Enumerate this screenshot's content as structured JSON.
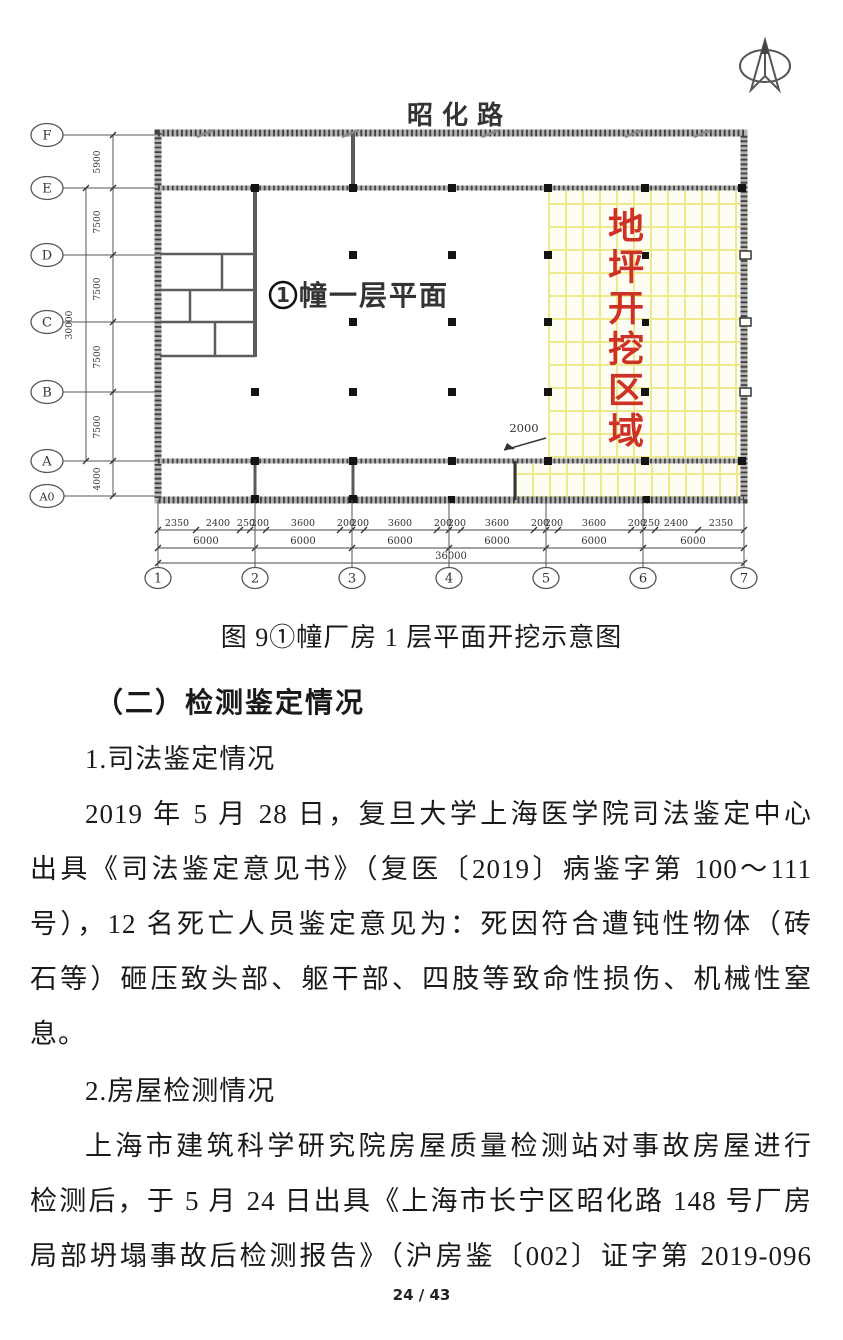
{
  "plan": {
    "road_label": "昭 化 路",
    "unit_circle_digit": "1",
    "unit_label": "幢一层平面",
    "excavation_label": "地坪开挖区域",
    "dim_2000": "2000",
    "row_axes": [
      "F",
      "E",
      "D",
      "C",
      "B",
      "A",
      "A0"
    ],
    "row_dims": [
      "5900",
      "7500",
      "7500",
      "7500",
      "7500",
      "4000"
    ],
    "row_total_dim": "30000",
    "col_axes": [
      "1",
      "2",
      "3",
      "4",
      "5",
      "6",
      "7"
    ],
    "dims_row1": [
      "2350",
      "2400",
      "250",
      "200",
      "3600",
      "200",
      "200",
      "3600",
      "200",
      "200",
      "3600",
      "200",
      "200",
      "3600",
      "200",
      "250",
      "2400",
      "2350"
    ],
    "dims_row2": [
      "6000",
      "6000",
      "6000",
      "6000",
      "6000",
      "6000"
    ],
    "dims_row3": "36000",
    "colors": {
      "excavation_text_red": "#ce3226",
      "hatch_line_yellow": "#ece98f",
      "hatch_bg": "#fefdf4"
    }
  },
  "caption": "图 9①幢厂房 1 层平面开挖示意图",
  "heading": "（二）检测鉴定情况",
  "body": {
    "lines": [
      "1.司法鉴定情况",
      "2019 年 5 月 28 日，复旦大学上海医学院司法鉴定中心",
      "出具《司法鉴定意见书》（复医〔2019〕病鉴字第 100～111",
      "号），12 名死亡人员鉴定意见为：死因符合遭钝性物体（砖",
      "石等）砸压致头部、躯干部、四肢等致命性损伤、机械性窒",
      "息。",
      "2.房屋检测情况",
      "上海市建筑科学研究院房屋质量检测站对事故房屋进行",
      "检测后，于 5 月 24 日出具《上海市长宁区昭化路 148 号厂房",
      "局部坍塌事故后检测报告》（沪房鉴〔002〕证字第 2019-096"
    ]
  },
  "footer": {
    "page_indicator": "24 / 43"
  }
}
